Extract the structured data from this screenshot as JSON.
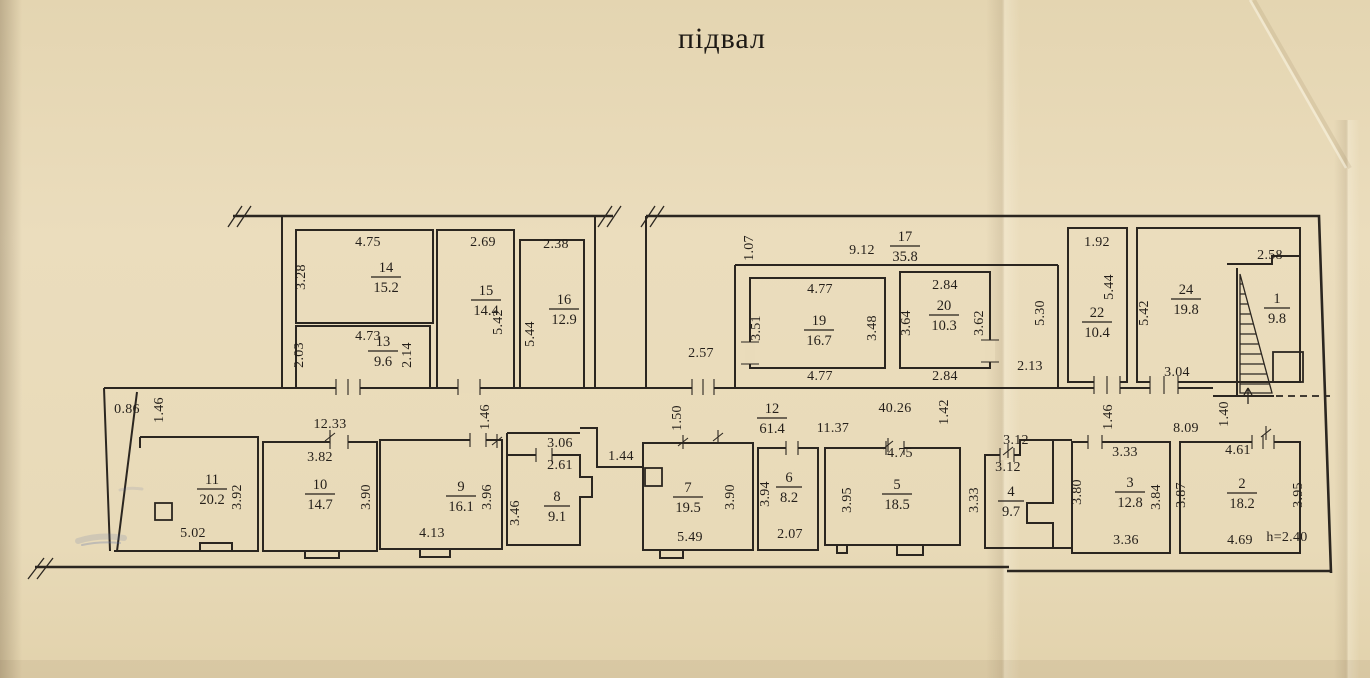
{
  "title": "підвал",
  "colors": {
    "paper": "#e9dbba",
    "ink": "#2b2620",
    "stamp_blue": "#5f74ad"
  },
  "rooms": {
    "r1": {
      "number": "1",
      "area": "9.8"
    },
    "r2": {
      "number": "2",
      "area": "18.2"
    },
    "r3": {
      "number": "3",
      "area": "12.8"
    },
    "r4": {
      "number": "4",
      "area": "9.7"
    },
    "r5": {
      "number": "5",
      "area": "18.5"
    },
    "r6": {
      "number": "6",
      "area": "8.2"
    },
    "r7": {
      "number": "7",
      "area": "19.5"
    },
    "r8": {
      "number": "8",
      "area": "9.1"
    },
    "r9": {
      "number": "9",
      "area": "16.1"
    },
    "r10": {
      "number": "10",
      "area": "14.7"
    },
    "r11": {
      "number": "11",
      "area": "20.2"
    },
    "r12": {
      "number": "12",
      "area": "61.4"
    },
    "r13": {
      "number": "13",
      "area": "9.6"
    },
    "r14": {
      "number": "14",
      "area": "15.2"
    },
    "r15": {
      "number": "15",
      "area": "14.4"
    },
    "r16": {
      "number": "16",
      "area": "12.9"
    },
    "r17": {
      "number": "17",
      "area": "35.8"
    },
    "r19": {
      "number": "19",
      "area": "16.7"
    },
    "r20": {
      "number": "20",
      "area": "10.3"
    },
    "r22": {
      "number": "22",
      "area": "10.4"
    },
    "r24": {
      "number": "24",
      "area": "19.8"
    }
  },
  "dims": {
    "r14_top": "4.75",
    "r14_left": "3.28",
    "r13_top": "4.73",
    "r13_left": "2.03",
    "r13_right": "2.14",
    "r15_top": "2.69",
    "r15_right": "5.42",
    "r16_top": "2.38",
    "r16_left": "5.44",
    "c17_left": "1.07",
    "c17_top": "9.12",
    "c17_entry": "2.57",
    "c17_right": "2.13",
    "c17_side": "5.30",
    "r19_top": "4.77",
    "r19_left": "3.51",
    "r19_right": "3.48",
    "r19_bottom": "4.77",
    "r20_top": "2.84",
    "r20_left": "3.64",
    "r20_right": "3.62",
    "r20_bottom": "2.84",
    "r22_top": "1.92",
    "r22_right": "5.44",
    "r24_left": "5.42",
    "r24_bottom": "3.04",
    "r1_top": "2.58",
    "c12_left_w": "0.86",
    "c12_left_h": "1.46",
    "c12_left_run": "12.33",
    "r11_right": "3.92",
    "r11_bottom": "5.02",
    "r10_top": "3.82",
    "r10_right": "3.90",
    "r9_right": "3.96",
    "r9_bottom": "4.13",
    "c12_mid_h": "1.46",
    "r8_top": "3.06",
    "r8_top2": "2.61",
    "r8_left": "3.46",
    "c12_pass": "1.44",
    "c12_step": "1.50",
    "c12_run": "40.26",
    "c12_run2": "11.37",
    "c12_h": "1.42",
    "r7_bottom": "5.49",
    "r7_right": "3.90",
    "r6_left": "3.94",
    "r6_bottom": "2.07",
    "r5_top": "4.75",
    "r5_left": "3.95",
    "r4_top": "3.12",
    "r4_top2": "3.12",
    "r4_left": "3.33",
    "c12_right_h": "1.46",
    "c12_right_run": "8.09",
    "c12_right_h2": "1.40",
    "r3_top": "3.33",
    "r3_left": "3.80",
    "r3_right": "3.84",
    "r3_bottom": "3.36",
    "r2_top": "4.61",
    "r2_left": "3.87",
    "r2_right": "3.95",
    "r2_bottom": "4.69",
    "height_note": "h=2.40"
  }
}
